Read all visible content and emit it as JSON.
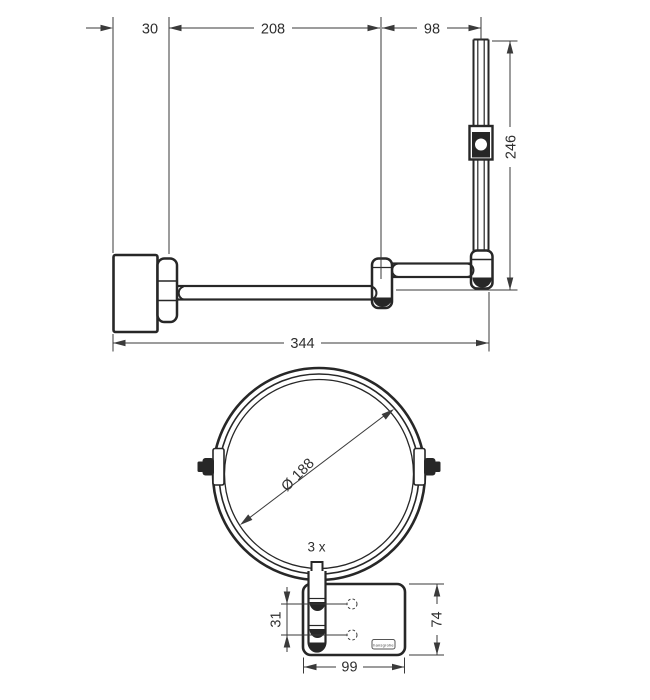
{
  "colors": {
    "background": "#ffffff",
    "object_line": "#272727",
    "dimension_line": "#3a3a3a",
    "text": "#2e2e2e"
  },
  "side_view": {
    "dims": {
      "wall_offset": "30",
      "lower_arm_reach": "208",
      "upper_arm_reach": "98",
      "bar_height": "246",
      "total_reach": "344"
    }
  },
  "front_view": {
    "dims": {
      "mirror_diameter": "Ø 188",
      "screw_hole_spacing": "31",
      "plate_height": "74",
      "plate_width": "99"
    },
    "magnification": "3 x",
    "brand_label": "hansgrohe"
  }
}
